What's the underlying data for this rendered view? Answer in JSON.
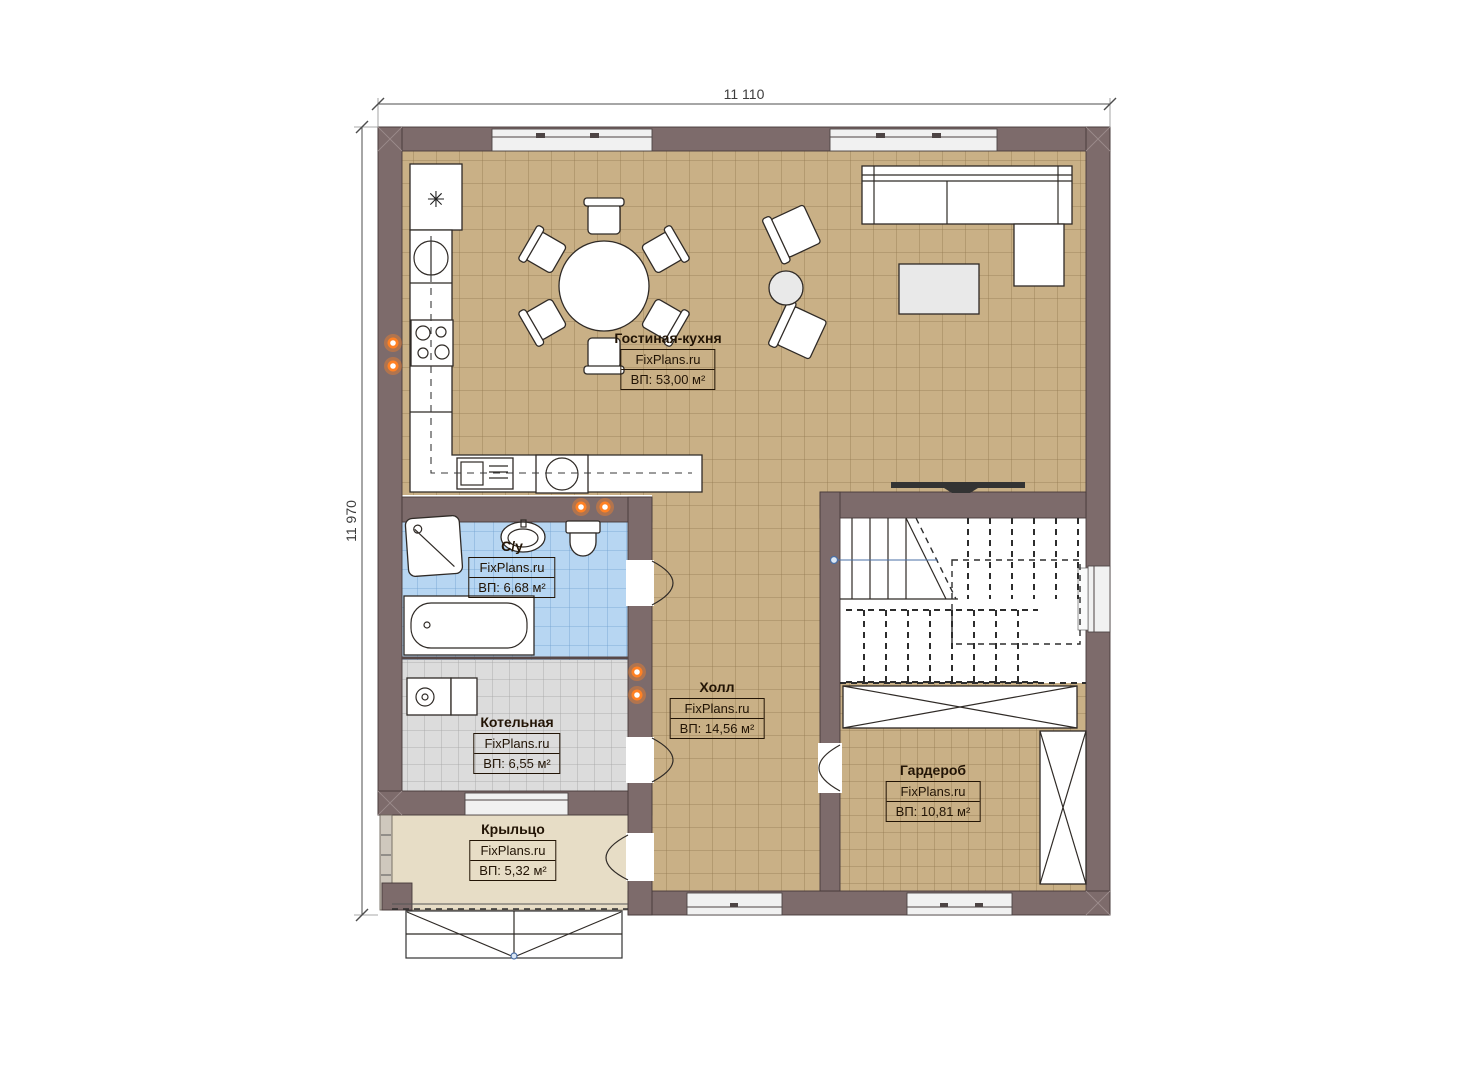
{
  "plan": {
    "dimension_width": "11 110",
    "dimension_height": "11 970",
    "rooms": [
      {
        "id": "living-kitchen",
        "name": "Гостиная-кухня",
        "brand": "FixPlans.ru",
        "area": "ВП: 53,00 м²"
      },
      {
        "id": "bathroom",
        "name": "С/у",
        "brand": "FixPlans.ru",
        "area": "ВП: 6,68 м²"
      },
      {
        "id": "boiler",
        "name": "Котельная",
        "brand": "FixPlans.ru",
        "area": "ВП: 6,55 м²"
      },
      {
        "id": "hall",
        "name": "Холл",
        "brand": "FixPlans.ru",
        "area": "ВП: 14,56 м²"
      },
      {
        "id": "wardrobe",
        "name": "Гардероб",
        "brand": "FixPlans.ru",
        "area": "ВП: 10,81 м²"
      },
      {
        "id": "porch",
        "name": "Крыльцо",
        "brand": "FixPlans.ru",
        "area": "ВП: 5,32 м²"
      }
    ],
    "icons": {
      "fridge_star": "✳"
    },
    "colors": {
      "wall": "#7d6b6b",
      "floor_main": "#c9b086",
      "floor_bathroom": "#b7d6f2",
      "floor_boiler": "#dcdcdc",
      "floor_porch": "#e7ddc6",
      "accent_orange": "#ff8124"
    }
  }
}
